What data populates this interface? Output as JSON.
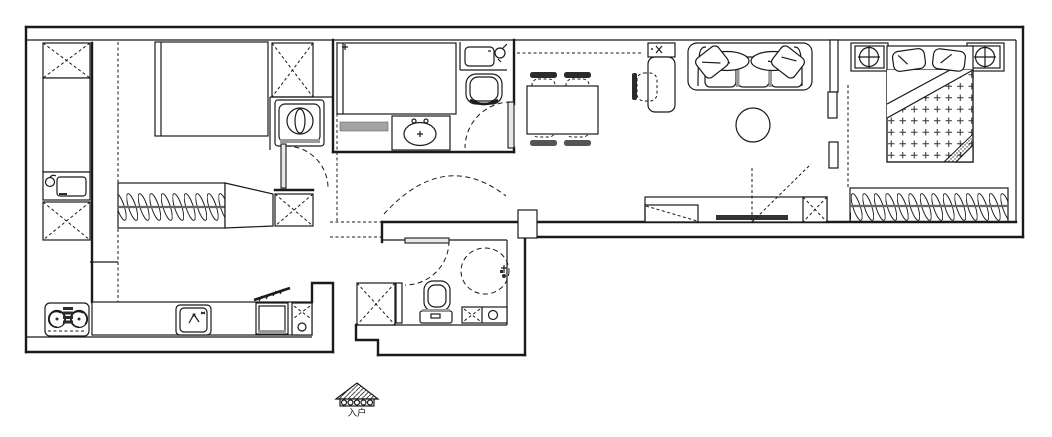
{
  "app": {
    "type": "apartment-floor-plan",
    "background_color": "#ffffff",
    "line_color": "#1a1a1a",
    "gray_accent": "#999999"
  },
  "entrance": {
    "label": "入户"
  },
  "rooms": {
    "left_balcony": {
      "items": [
        "storage-cabinet-x",
        "tall-cabinet",
        "utility-sink",
        "storage-cabinet-x"
      ]
    },
    "second_bedroom": {
      "items": [
        "bed",
        "cabinet-x",
        "washing-machine",
        "wardrobe-hangers",
        "side-dresser",
        "shoe-bench-x",
        "door-swing"
      ]
    },
    "study_room": {
      "items": [
        "single-bed",
        "dressing-table-basin",
        "wash-basin-with-kettle",
        "chair",
        "door-swing"
      ]
    },
    "dining_area": {
      "items": [
        "dining-table",
        "chair",
        "chair",
        "chair",
        "chair",
        "tall-cabinet-desk",
        "desk-chair",
        "overhead-cabinet-dashed"
      ]
    },
    "living_room": {
      "items": [
        "three-seat-sofa",
        "throw-pillow",
        "throw-pillow",
        "round-coffee-table",
        "tv-console",
        "tv",
        "cabinet-x",
        "door-swing-dashed"
      ]
    },
    "master_bedroom": {
      "items": [
        "double-bed",
        "pillow",
        "pillow",
        "nightstand-lamp",
        "nightstand-lamp",
        "wardrobe-hangers"
      ]
    },
    "bathroom": {
      "items": [
        "shower-area-dashed",
        "shower-head",
        "toilet",
        "vanity-x",
        "round-basin",
        "cabinet-x",
        "door-swing"
      ]
    },
    "kitchen": {
      "items": [
        "gas-stove",
        "kitchen-sink",
        "top-load-washer-open-lid",
        "water-heater-cabinet"
      ]
    },
    "hallway": {
      "items": [
        "wall-pier",
        "door-swing-arc"
      ]
    }
  }
}
